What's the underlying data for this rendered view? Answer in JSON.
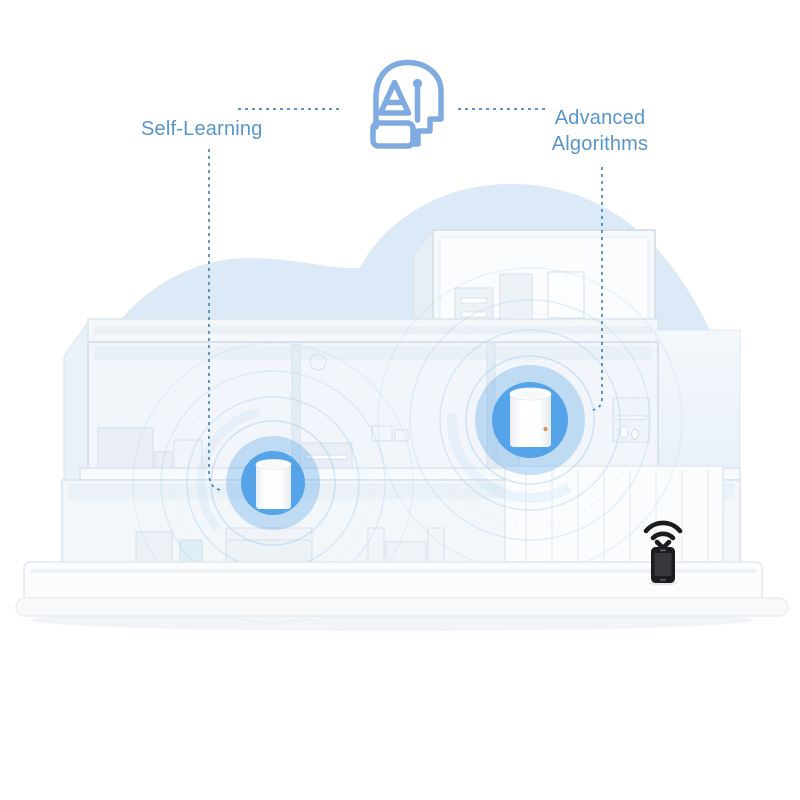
{
  "callouts": {
    "self_learning": {
      "label": "Self-Learning"
    },
    "advanced_algorithms": {
      "line1": "Advanced",
      "line2": "Algorithms"
    }
  },
  "icons": {
    "ai_head": "ai-head-icon",
    "wifi_signal": "wifi-signal-icon",
    "smartphone": "smartphone-icon",
    "mesh_unit": "mesh-wifi-unit"
  },
  "scene": {
    "mesh_unit_count": 2,
    "elements": [
      "cloud-background",
      "house-cutaway",
      "mesh-wifi-unit-left",
      "mesh-wifi-unit-right",
      "smartphone-with-wifi",
      "base-platform"
    ]
  },
  "colors": {
    "background": "#FFFFFF",
    "label_text": "#5796CB",
    "connector_blue": "#4784C4",
    "ai_icon_stroke": "#7FABE0",
    "unit_circle_blue": "#55A3E8",
    "ripple_blue": "#A9CCEA",
    "cloud_blue": "#DCE9F6",
    "unit_led_orange": "#DE8F3F",
    "phone_black": "#1B1C1E"
  }
}
